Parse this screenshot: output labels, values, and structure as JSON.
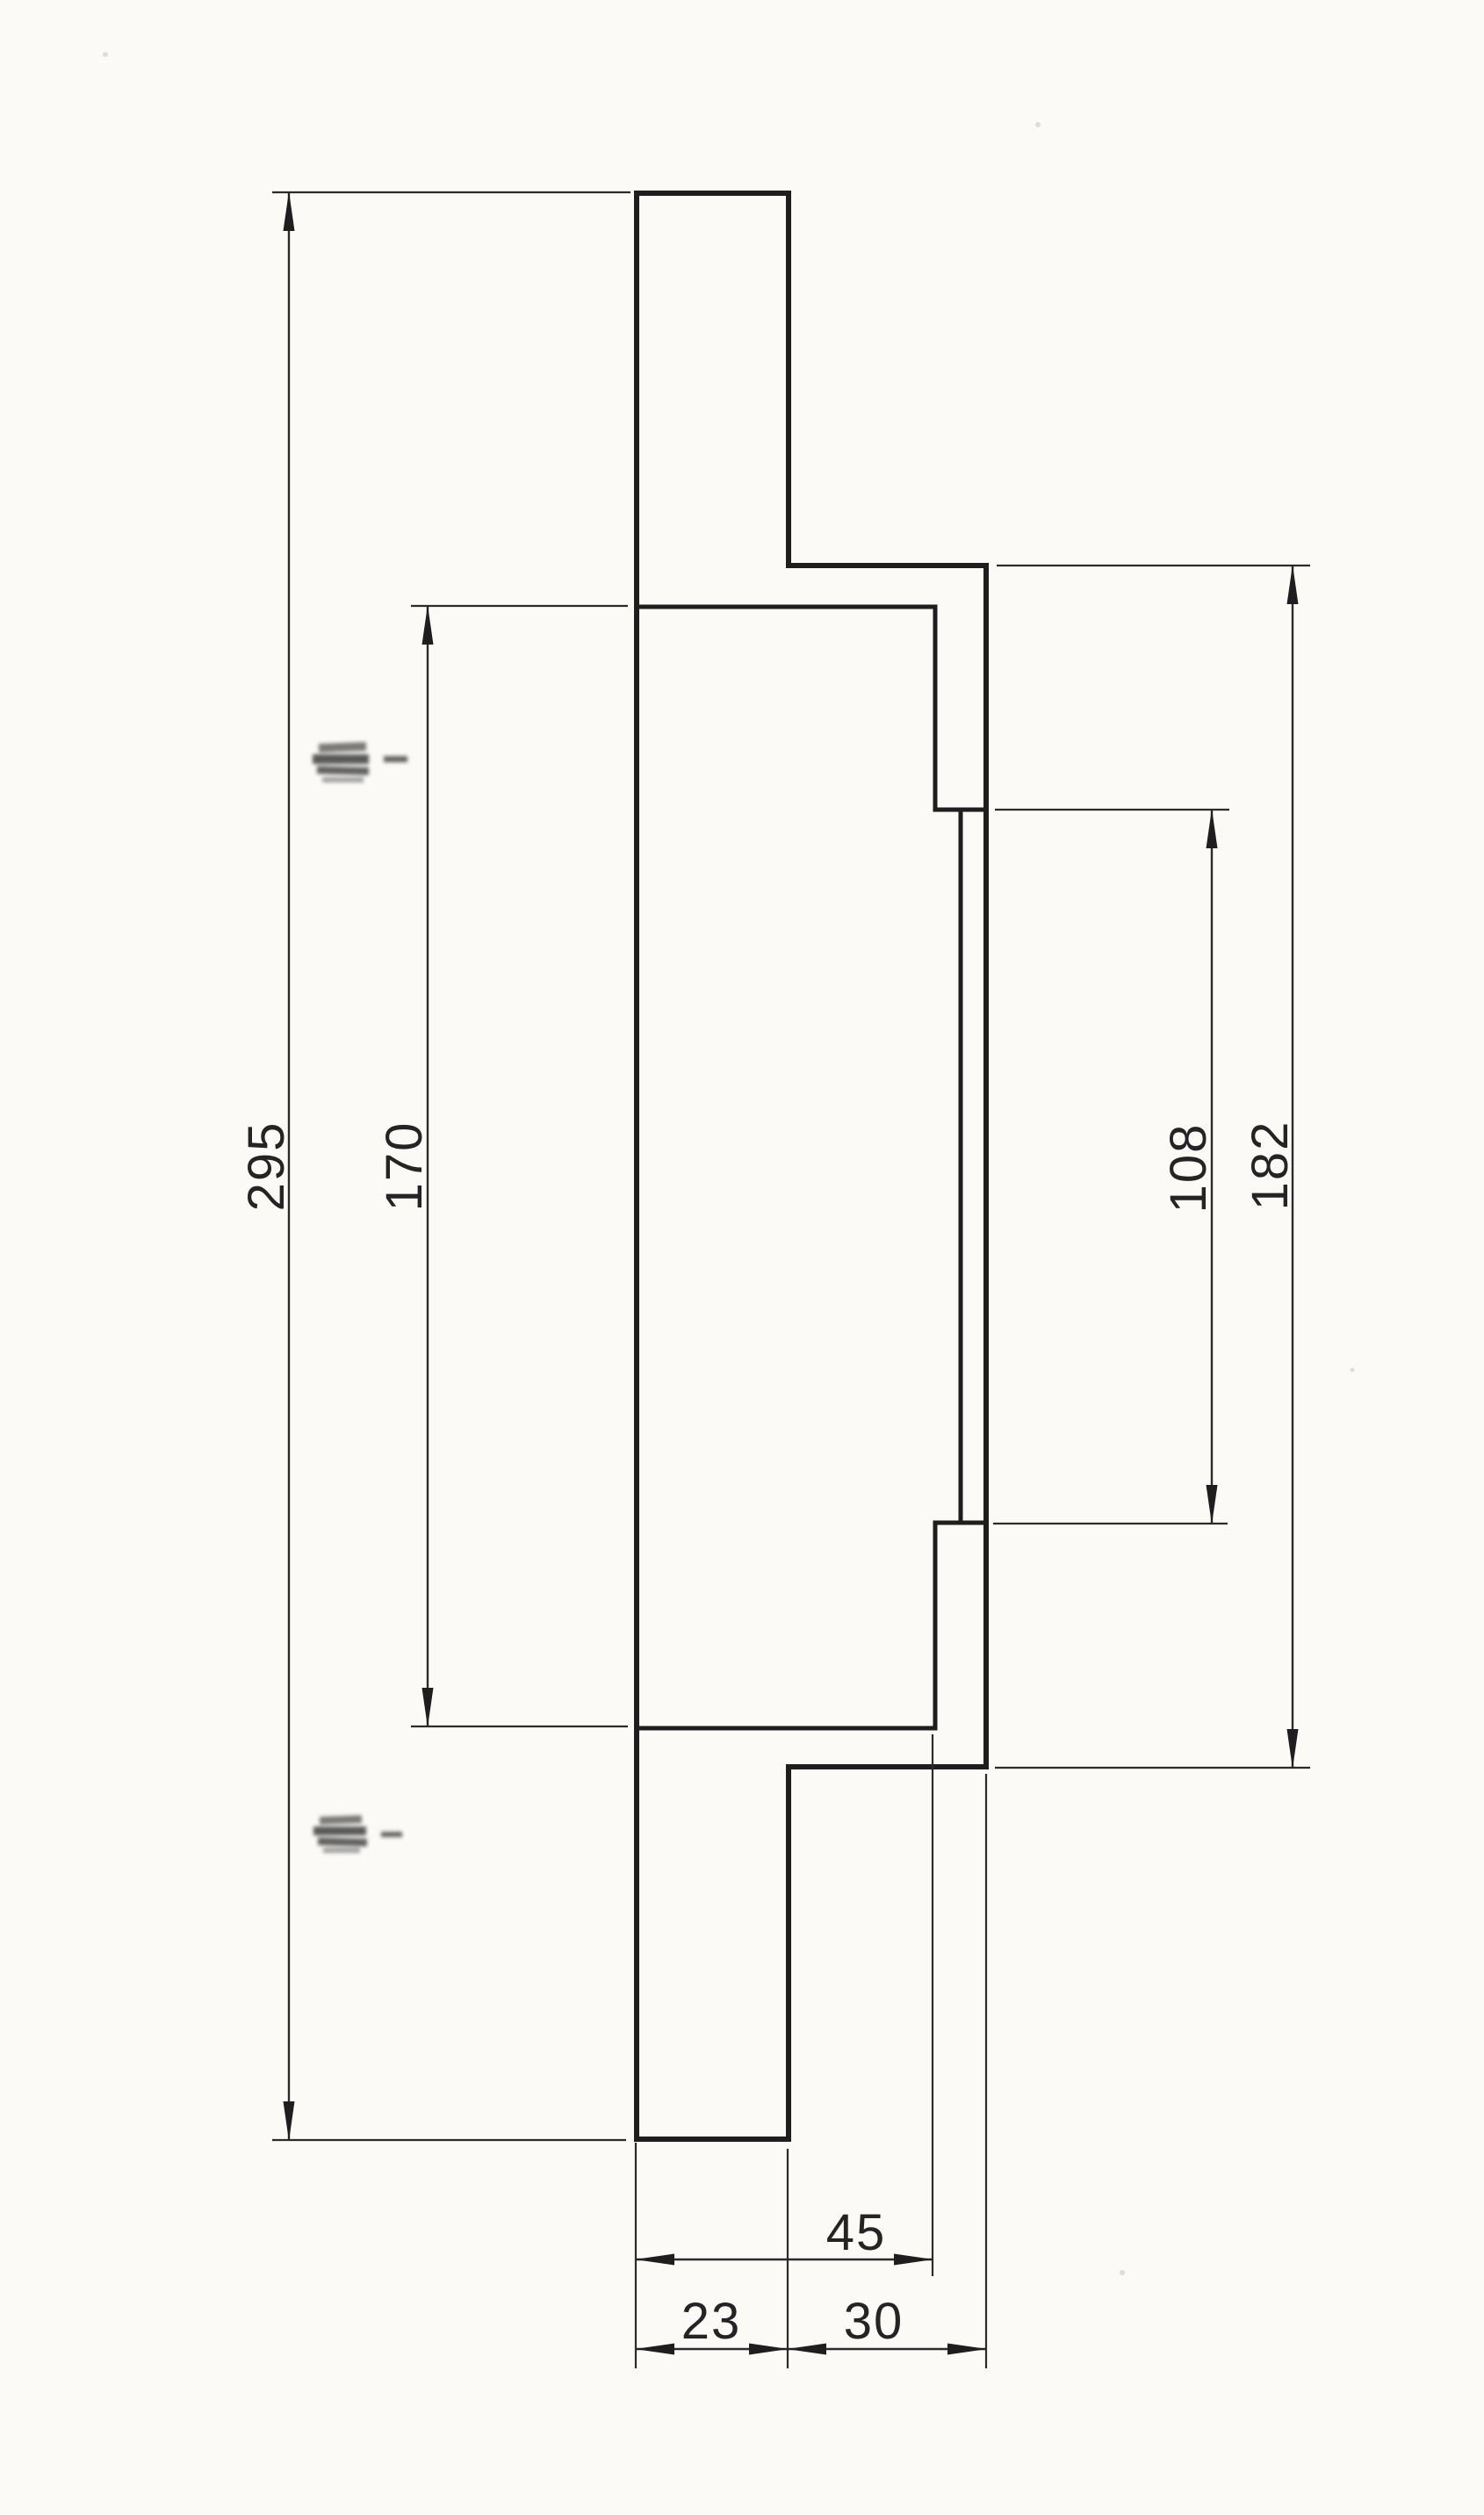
{
  "drawing": {
    "paper_color": "#fbfaf7",
    "ink_color": "#1e1e1e",
    "thin_ink_color": "#2b2b2b",
    "measurements": {
      "overall_height": 295,
      "inner_face_height": 170,
      "band_height": 108,
      "ring_height": 182,
      "flange_depth": 45,
      "hub_width": 23,
      "ring_overhang": 30
    },
    "paths": {
      "outline": "M 725 220 H 898 V 644 H 1123 V 2012 H 898 V 2436 H 725 Z",
      "inner_top": "M 725 691 H 1065 V 922 H 1123",
      "inner_band": "M 1094 922 V 1734",
      "inner_bottom": "M 725 1968 H 1065 V 1734 H 1123",
      "extensions": "M 310 219 H 718 M 310 2437 H 713 M 468 690 H 715 M 468 1966 H 715 M 1133 922 H 1400 M 1131 1735 H 1398 M 1135 644 H 1492 M 1133 2013 H 1492 M 724 2440 V 2697 M 897 2447 V 2697 M 1062 1975 V 2592 M 1123 2020 V 2697"
    },
    "dims": {
      "d295": {
        "label": "295",
        "line": "M 329 219 V 2437"
      },
      "d170": {
        "label": "170",
        "line": "M 487 690 V 1966"
      },
      "d108": {
        "label": "108",
        "line": "M 1380 922 V 1735"
      },
      "d182": {
        "label": "182",
        "line": "M 1472 644 V 2013"
      },
      "d45": {
        "label": "45",
        "line": "M 724 2573 H 1062"
      },
      "d23": {
        "label": "23",
        "line": "M 724 2675 H 897"
      },
      "d30": {
        "label": "30",
        "line": "M 897 2675 H 1123"
      }
    }
  }
}
